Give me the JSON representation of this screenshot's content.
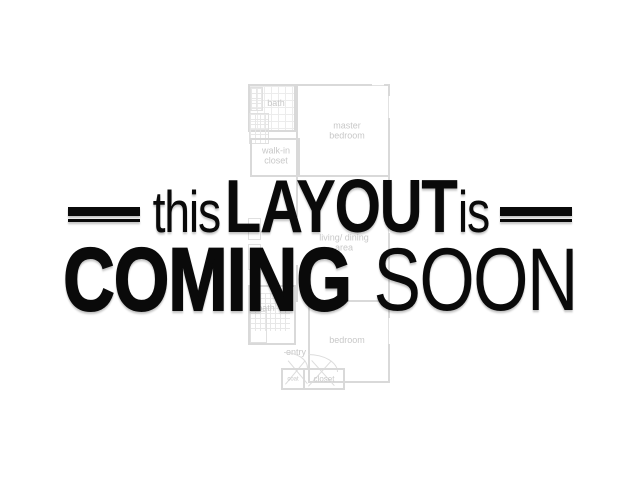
{
  "background_color": "#ffffff",
  "headline": {
    "word_this": "this",
    "word_layout": "LAYOUT",
    "word_is": "is",
    "word_coming": "COMING",
    "word_soon": "SOON",
    "text_color": "#0a0a0a"
  },
  "floorplan": {
    "wall_color": "#d9d9d9",
    "label_color": "#c8c8c8",
    "labels": {
      "bath_top": "bath",
      "master_bedroom": "master bedroom",
      "walk_in_closet": "walk-in closet",
      "living_dining": "living/ dining area",
      "bath_bottom": "bath",
      "bedroom": "bedroom",
      "entry": "entry",
      "coat_closet": "coat",
      "closet": "closet"
    }
  }
}
